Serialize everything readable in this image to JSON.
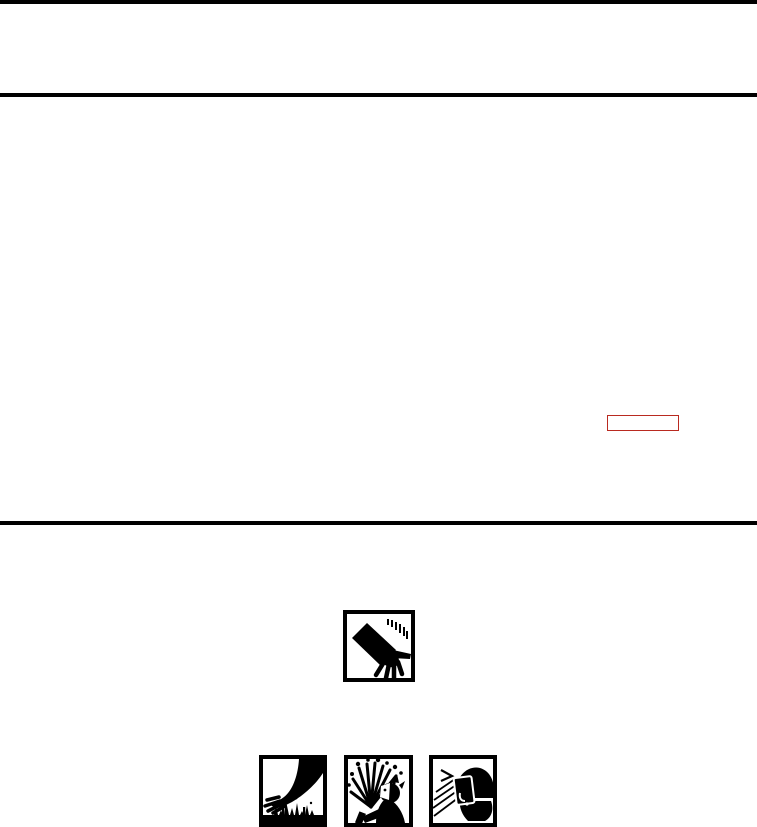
{
  "page": {
    "background_color": "#ffffff",
    "rule_color": "#000000"
  },
  "link_annotation": {
    "name": "link-annotation-box",
    "border_color": "#b92a20"
  },
  "icons": {
    "hand_cut": "hand-cut-hazard-icon",
    "sharp_objects": "sharp-objects-hazard-icon",
    "fluid_splash": "fluid-splash-hazard-icon",
    "face_shield": "face-shield-protection-icon"
  }
}
